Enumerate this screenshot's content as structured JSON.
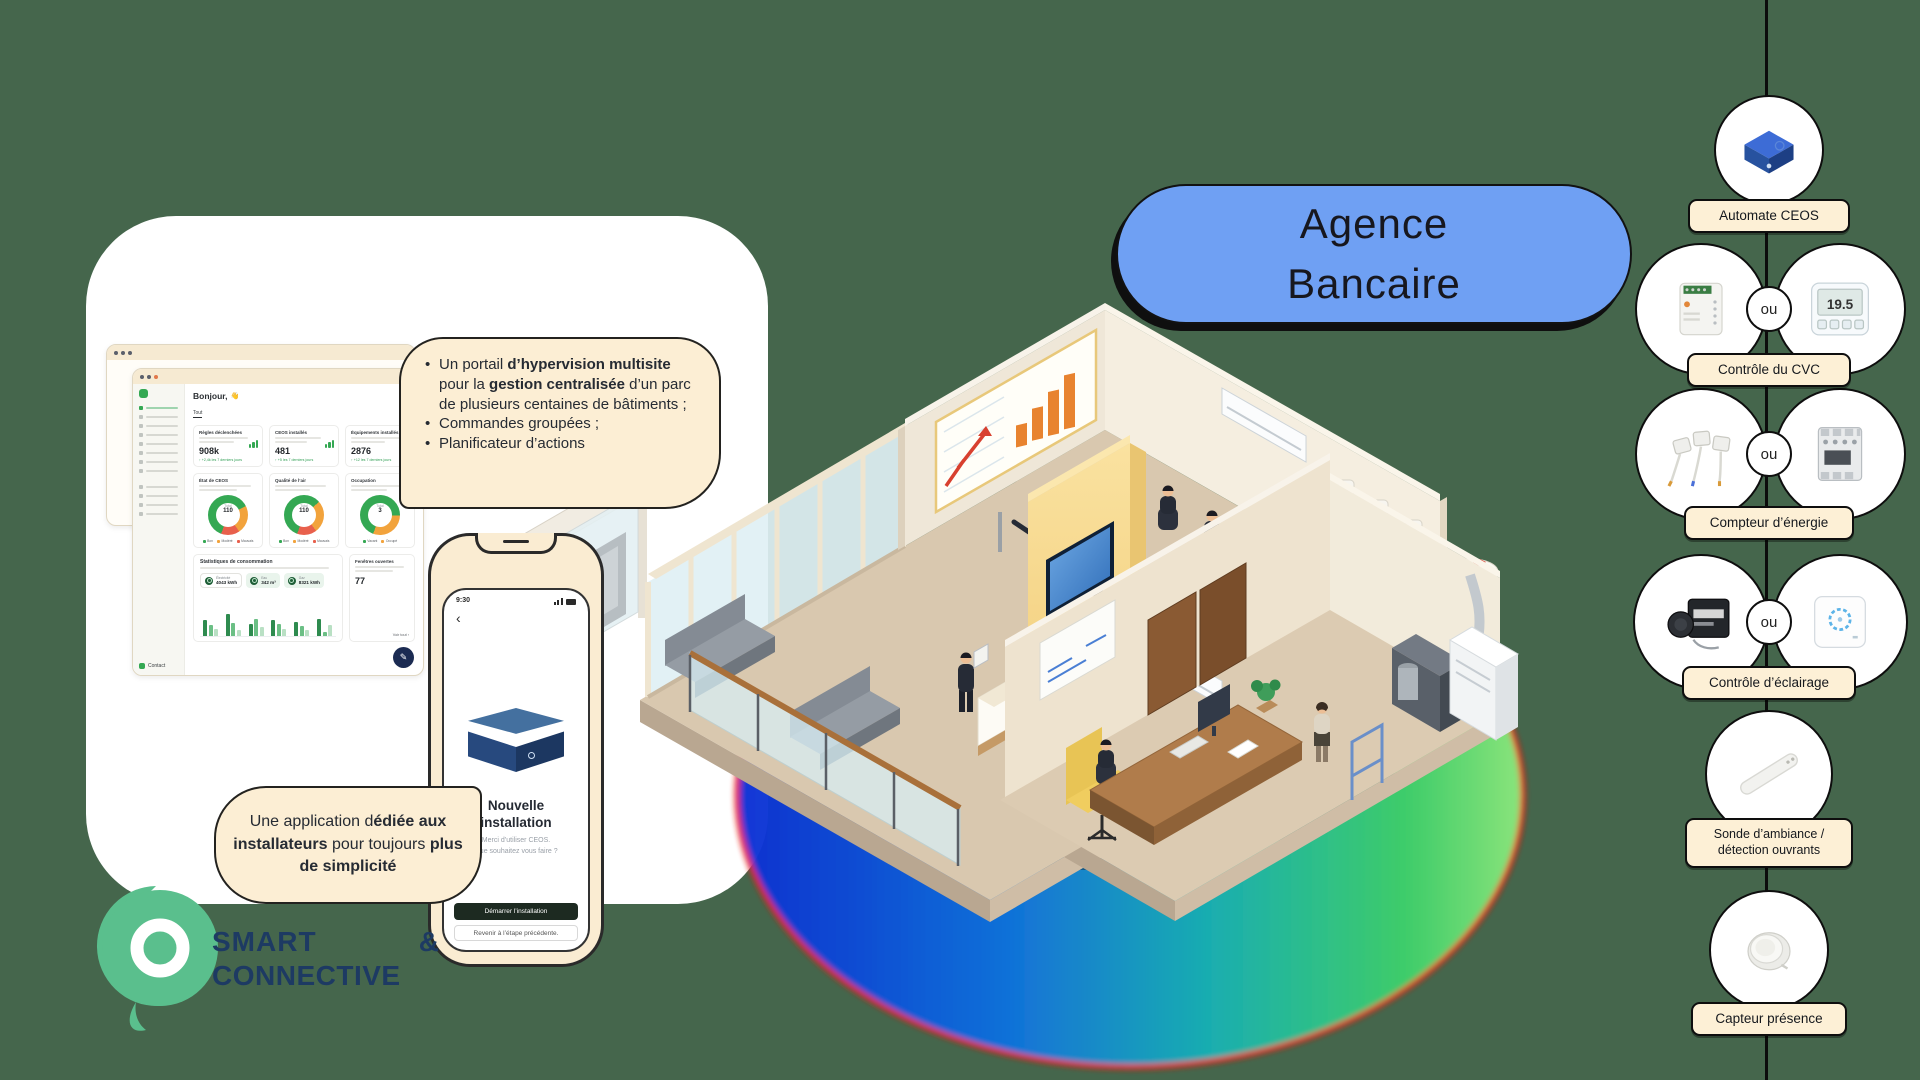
{
  "colors": {
    "background": "#45664C",
    "pill_blue": "#6FA0F3",
    "cream": "#FCEED4",
    "logo_green": "#5ABF8D",
    "logo_navy": "#1D3A63",
    "dashboard_green": "#34A853"
  },
  "title_pill": {
    "line1": "Agence",
    "line2": "Bancaire"
  },
  "hypervision_callout": {
    "b1_t1": "Un portail ",
    "b1_b1": "d’hypervision multisite",
    "b1_t2": " pour la ",
    "b1_b2": "gestion centralisée",
    "b1_t3": " d’un parc de plusieurs centaines de bâtiments ;",
    "bullet2": "Commandes groupées ;",
    "bullet3": "Planificateur d’actions"
  },
  "installer_callout": {
    "t1": "Une application d",
    "b1": "édiée aux installateurs",
    "t2": " pour toujours ",
    "b2": "plus de simplicité"
  },
  "logo": {
    "word1": "SMART",
    "amp": "&",
    "word2": "CONNECTIVE"
  },
  "dashboard": {
    "greeting": "Bonjour,",
    "wave": "👋",
    "tab": "Tout",
    "stats": [
      {
        "title": "Règles déclenchées",
        "value": "908k",
        "delta": "↑ +2,4k les 7 derniers jours"
      },
      {
        "title": "CEOS installés",
        "value": "481",
        "delta": "↑ +5 les 7 derniers jours"
      },
      {
        "title": "Équipements installés",
        "value": "2876",
        "delta": "↑ +12 les 7 derniers jours"
      }
    ],
    "donuts": [
      {
        "title": "État de CEOS",
        "center_label": "Total",
        "center_value": "110",
        "legend": [
          "Bon",
          "Modéré",
          "Mauvais"
        ],
        "segments": [
          62,
          23,
          15
        ]
      },
      {
        "title": "Qualité de l’air",
        "center_label": "Total",
        "center_value": "110",
        "legend": [
          "Bon",
          "Modéré",
          "Mauvais"
        ],
        "segments": [
          58,
          26,
          16
        ]
      },
      {
        "title": "Occupation",
        "center_label": "Total",
        "center_value": "3",
        "legend": [
          "Vacant",
          "Occupé"
        ],
        "segments": [
          70,
          30
        ]
      }
    ],
    "consumption": {
      "title": "Statistiques de consommation",
      "chips": [
        {
          "label": "Électricité",
          "value": "4043 kWh"
        },
        {
          "label": "Eau",
          "value": "342 m³"
        },
        {
          "label": "Gaz",
          "value": "8321 kWh"
        }
      ],
      "bars": [
        [
          16,
          11,
          7
        ],
        [
          22,
          13,
          6
        ],
        [
          12,
          17,
          9
        ],
        [
          16,
          12,
          7
        ],
        [
          14,
          10,
          6
        ],
        [
          17,
          4,
          11
        ]
      ],
      "bar_colors": [
        "#2e8b4f",
        "#6bbf85",
        "#b9e0c4"
      ]
    },
    "windows_card": {
      "title": "Fenêtres ouvertes",
      "value": "77",
      "link": "Voir tout ›"
    },
    "contact": "Contact"
  },
  "phone": {
    "time": "9:30",
    "back_icon": "‹",
    "title_line1": "Nouvelle",
    "title_line2": "installation",
    "subtitle_line1": "Merci d’utiliser CEOS.",
    "subtitle_line2": "Que souhaitez vous faire ?",
    "primary_button": "Démarrer l’installation",
    "secondary_button": "Revenir à l’étape précédente."
  },
  "devices": {
    "connector": "ou",
    "automate": {
      "label": "Automate CEOS"
    },
    "cvc": {
      "label": "Contrôle du CVC",
      "thermostat_value": "19.5"
    },
    "energie": {
      "label": "Compteur d’énergie"
    },
    "eclairage": {
      "label": "Contrôle d’éclairage"
    },
    "sonde": {
      "label_line1": "Sonde d’ambiance /",
      "label_line2": "détection ouvrants"
    },
    "presence": {
      "label": "Capteur présence"
    }
  }
}
